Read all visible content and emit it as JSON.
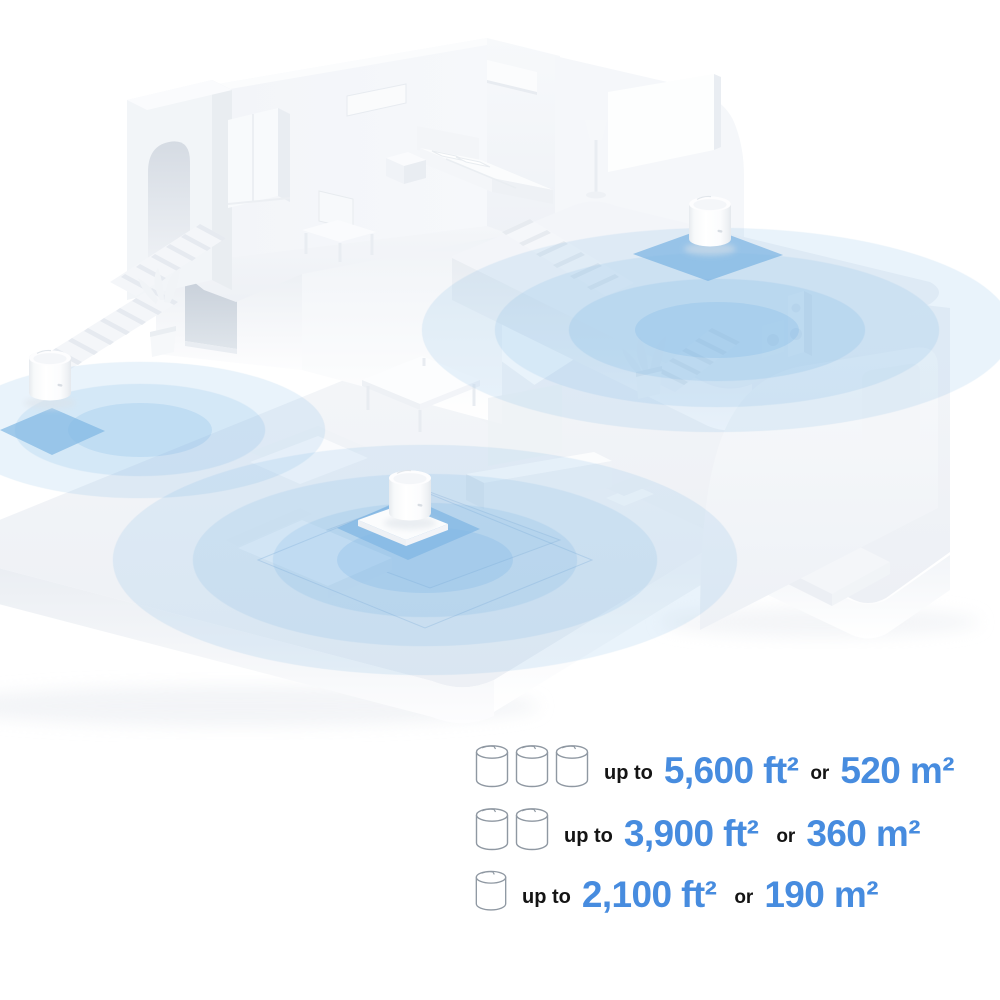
{
  "legend": {
    "rows": [
      {
        "units": 3,
        "icon": "deco-cylinder-icon",
        "prefix": "up to",
        "area_imperial": "5,600 ft²",
        "conjunction": "or",
        "area_metric": "520 m²"
      },
      {
        "units": 2,
        "icon": "deco-cylinder-icon",
        "prefix": "up to",
        "area_imperial": "3,900 ft²",
        "conjunction": "or",
        "area_metric": "360 m²"
      },
      {
        "units": 1,
        "icon": "deco-cylinder-icon",
        "prefix": "up to",
        "area_imperial": "2,100 ft²",
        "conjunction": "or",
        "area_metric": "190 m²"
      }
    ]
  },
  "scene": {
    "wifi_units_visible": 3,
    "coverage_zones_visible": 3,
    "node_label": "mesh-wifi-unit"
  },
  "colors": {
    "accent_blue": "#478CDF",
    "text_dark": "#141414",
    "ripple_blue": "#5CA8E2",
    "platform_blue": "#7FB6E3",
    "house_gray": "#F2F4F8",
    "background": "#FFFFFF"
  }
}
